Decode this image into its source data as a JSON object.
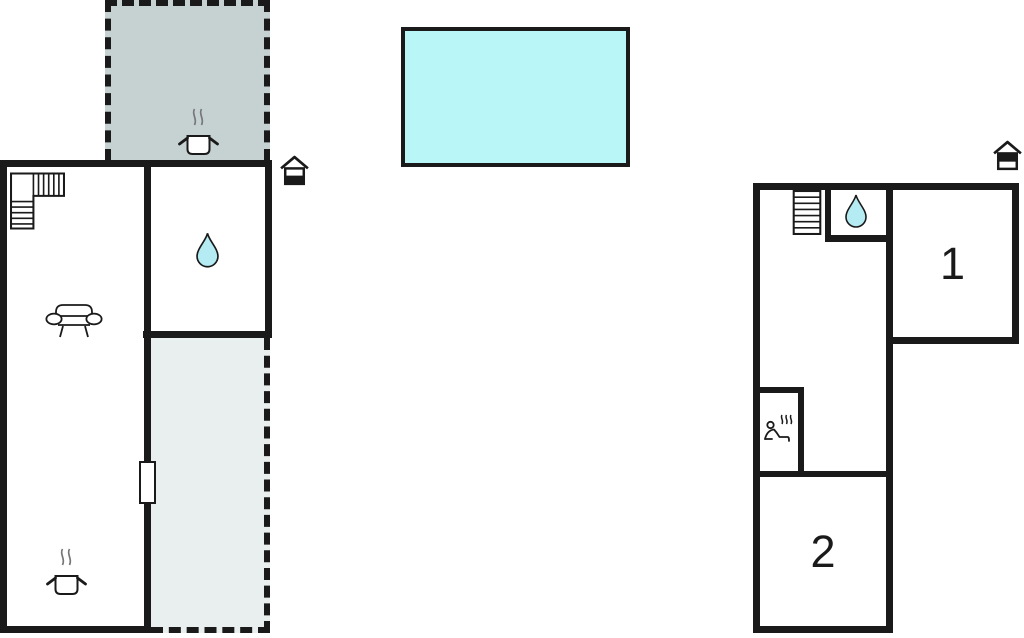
{
  "title": "Holiday home floor plan",
  "colors": {
    "wall": "#1a1a1a",
    "terrace_upper_fill": "#c6d2d2",
    "terrace_lower_fill": "#e9eeee",
    "pool_fill": "#b9f6f7",
    "water_drop_fill": "#b5ecf4",
    "steam": "#777777",
    "background": "#ffffff"
  },
  "left_unit": {
    "terrace_upper": {
      "icons": [
        "cooking-pot-icon"
      ]
    },
    "main_room": {
      "icons": [
        "stairs-icon",
        "sofa-icon",
        "cooking-pot-icon"
      ]
    },
    "bathroom": {
      "icons": [
        "water-drop-icon"
      ]
    },
    "terrace_lower": {
      "icons": []
    },
    "entrance_marker": "house-entrance-icon",
    "door": "door-opening"
  },
  "pool": {
    "type": "swimming-pool"
  },
  "right_unit": {
    "hall": {
      "icons": [
        "stairs-icon"
      ]
    },
    "bathroom": {
      "icons": [
        "water-drop-icon"
      ]
    },
    "sauna": {
      "icons": [
        "sauna-icon"
      ]
    },
    "bedroom_1": {
      "label": "1"
    },
    "bedroom_2": {
      "label": "2"
    },
    "entrance_marker": "house-entrance-icon"
  }
}
